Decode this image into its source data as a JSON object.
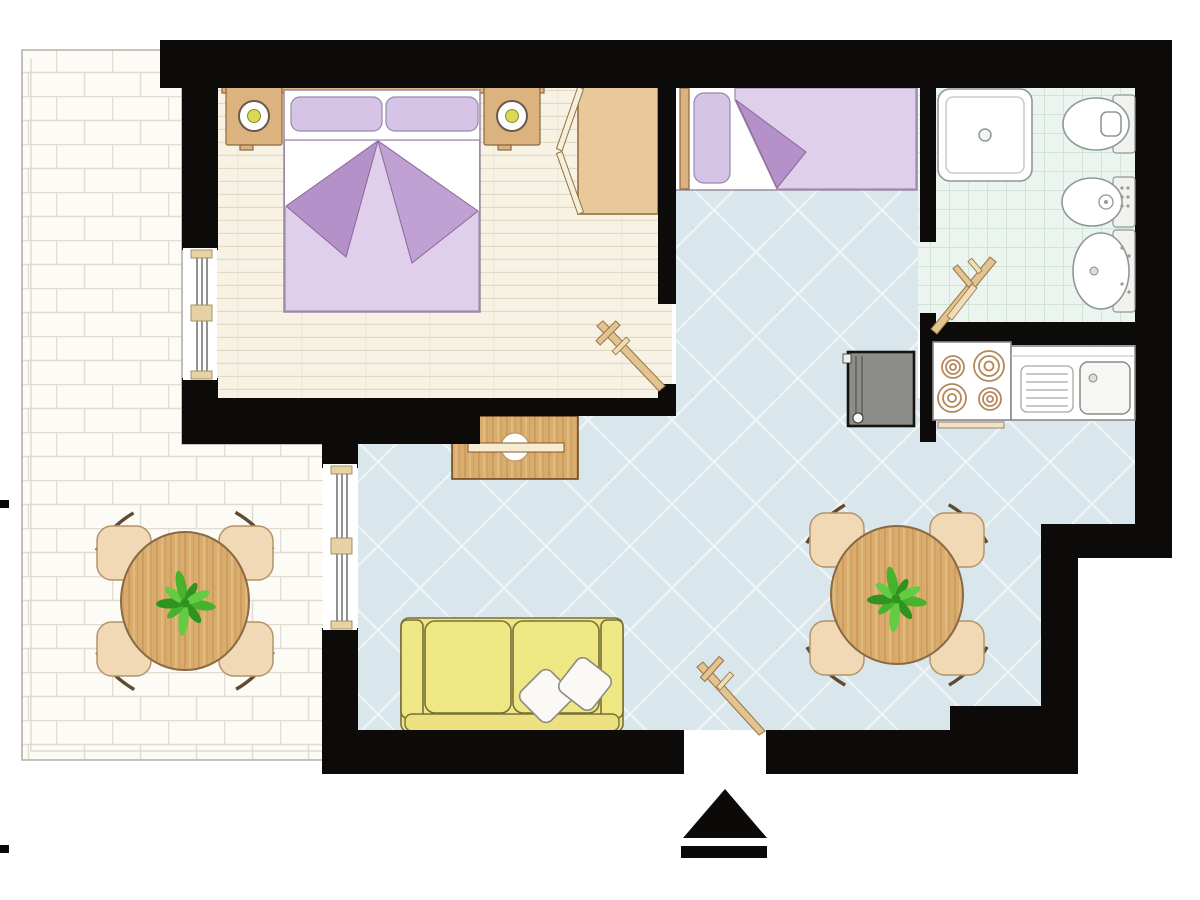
{
  "meta": {
    "type": "apartment-floor-plan",
    "visible_text": "none",
    "orientation_marker": "entrance-arrow"
  },
  "palette": {
    "wall": "#0d0a0a",
    "brick-bg": "#fcfbf6",
    "brick-line": "#e0dcd1",
    "terrace-edge": "#b3b0a7",
    "terrace-inner": "#d7d4ca",
    "plank-bg": "#f7f2e3",
    "plank-line": "#e1d9c3",
    "blue-bg": "#d9e6ec",
    "blue-line": "#eef4f6",
    "tile-bg": "#ecf4ef",
    "tile-line": "#d2e3d8",
    "wood": "#d9ab6d",
    "wood-grain1": "#c89a58",
    "wood-grain2": "#e7c389",
    "wood-edge": "#8a6a45",
    "chair": "#f0d9b4",
    "chair-edge": "#b3946a",
    "chair-arc": "#5f4a33",
    "tan": "#dcb27e",
    "tan-edge": "#8a6a40",
    "wardrobe": "#e9c99a",
    "wardrobe-edge": "#90743f",
    "wardrobe-door": "#f7eedc",
    "bed-white": "#ffffff",
    "bed-edge": "#9a8aa0",
    "pillow": "#d6c4e6",
    "pillow-edge": "#9688ac",
    "lav-light": "#dfcfeb",
    "lav-edge": "#9e8cb2",
    "lav-dark": "#b491c8",
    "lav-mid": "#c1a1d4",
    "wing-edge": "#8a6898",
    "sofa": "#efe784",
    "sofa-edge": "#76703a",
    "sofa-base": "#ece080",
    "sofa-pillow": "#fbf9f6",
    "sofa-pillow-edge": "#8a8a80",
    "door-tan": "#e3c392",
    "door-tan-light": "#efddba",
    "door-edge": "#9a7a48",
    "fx": "#ffffff",
    "fx-edge": "#8f9898",
    "fx-plate": "#f1f1ee",
    "burner": "#b5885c",
    "appliance": "#8c8c88",
    "appliance-edge": "#151212",
    "appliance-line": "#5f5f5b",
    "counter-edge": "#8a8a8a",
    "sink-fill": "#f6f6f3",
    "plant-1": "#46b22e",
    "plant-2": "#2f941f",
    "plant-3": "#63cc44",
    "lamp-dot": "#d8da54",
    "lamp-edge": "#6a5a4a",
    "trim": "#40261e",
    "window-cap": "#e6d2a4",
    "window-cap-edge": "#9a8a5a",
    "glazing": "#3a3a3a",
    "arrow": "#0c0909"
  },
  "legend": {
    "rooms": [
      "terrace",
      "bedroom",
      "single-bed-alcove",
      "living-room",
      "bathroom",
      "kitchen"
    ],
    "furniture": [
      "double-bed",
      "single-bed",
      "wardrobe",
      "nightstand",
      "table-lamp",
      "sofa",
      "cushion",
      "coffee-table",
      "dining-table",
      "dining-chair",
      "potted-plant",
      "shower",
      "toilet",
      "bidet",
      "washbasin",
      "stove",
      "kitchen-counter",
      "kitchen-sink",
      "appliance",
      "door",
      "window",
      "entrance-arrow"
    ],
    "counts": {
      "dining_tables": 2,
      "chairs_per_dining_table": 4,
      "stove_burners": 4,
      "sofa_cushions": 2,
      "beds": 2,
      "doors": 3,
      "windows": 2
    }
  }
}
